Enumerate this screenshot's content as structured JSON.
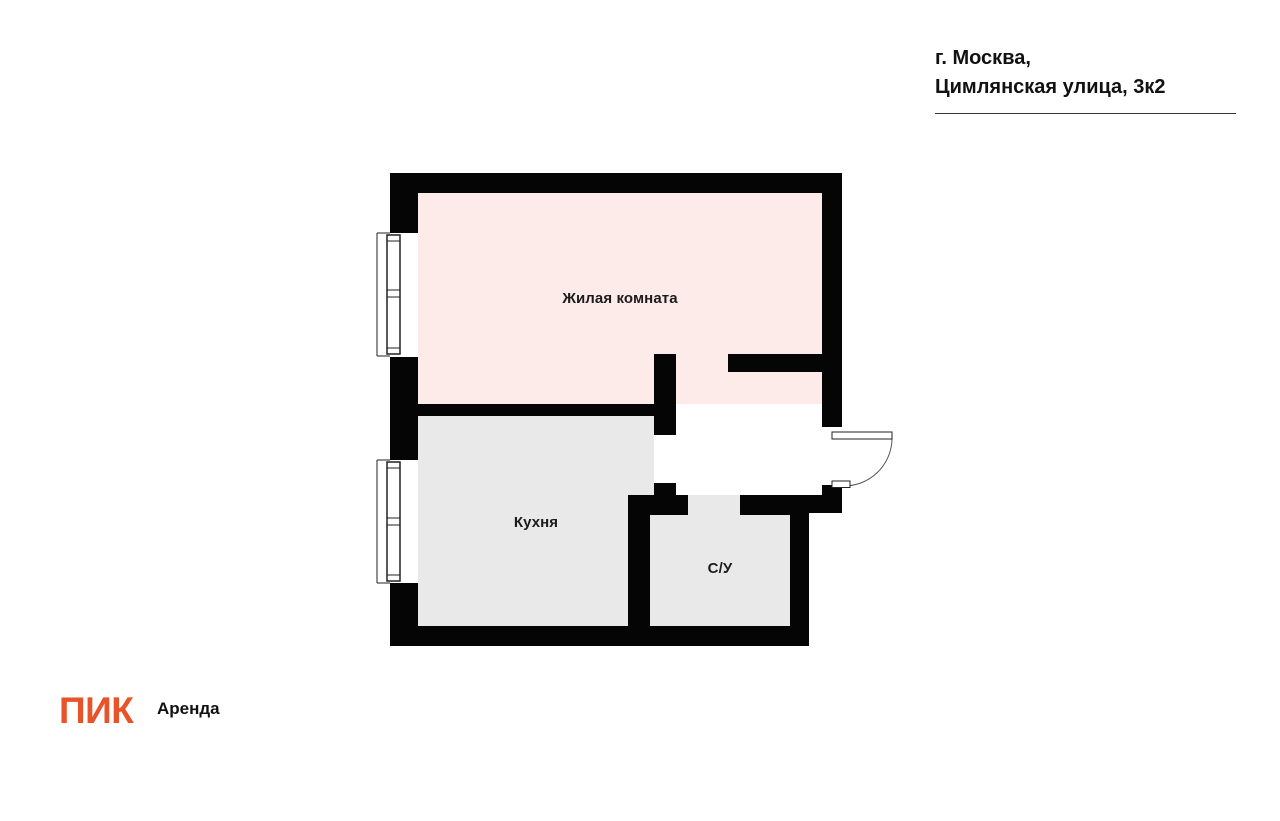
{
  "header": {
    "address_line1": "г. Москва,",
    "address_line2": "Цимлянская улица, 3к2"
  },
  "compass": {
    "north": "С",
    "south": "Ю",
    "west": "З",
    "east": "В"
  },
  "rooms": {
    "living": "Жилая комната",
    "kitchen": "Кухня",
    "bathroom": "С/У"
  },
  "footer": {
    "logo": "ПИК",
    "logo_suffix": "Аренда"
  },
  "colors": {
    "living_fill": "#fcebe8",
    "room_fill": "#e9e9e9",
    "wall": "#050505",
    "brand": "#e8532a",
    "needle_blue": "#2e3175",
    "needle_orange": "#f05a28",
    "text": "#111111"
  }
}
